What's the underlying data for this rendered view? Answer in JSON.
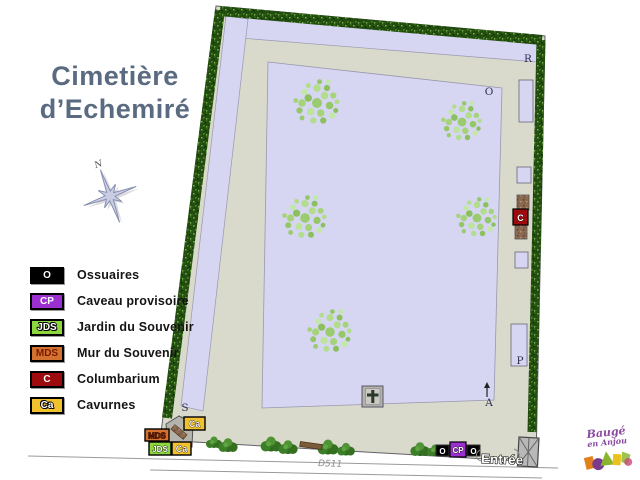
{
  "title": {
    "line1": "Cimetière",
    "line2": "d’Echemiré"
  },
  "compass": {
    "north": "N"
  },
  "legend": {
    "items": [
      {
        "code": "O",
        "label": "Ossuaires",
        "bg": "#000000",
        "fg": "#ffffff"
      },
      {
        "code": "CP",
        "label": "Caveau provisoire",
        "bg": "#9b2fd0",
        "fg": "#ffffff"
      },
      {
        "code": "JDS",
        "label": "Jardin du Souvenir",
        "bg": "#8cd73e",
        "fg": "#ffffff"
      },
      {
        "code": "MDS",
        "label": "Mur du Souvenir",
        "bg": "#d2722e",
        "fg": "#7b1a00"
      },
      {
        "code": "C",
        "label": "Columbarium",
        "bg": "#9e0b0f",
        "fg": "#ffffff"
      },
      {
        "code": "Ca",
        "label": "Cavurnes",
        "bg": "#f2c12e",
        "fg": "#ffffff"
      }
    ]
  },
  "map": {
    "sections": {
      "r": "R",
      "o": "O",
      "s": "S",
      "p": "P",
      "a": "A"
    },
    "markers": {
      "columbarium": "C",
      "cavurnes_top": "Ca",
      "mur_du_souvenir": "MDS",
      "jardin_du_souvenir": "JDS",
      "cavurnes_bottom": "Ca",
      "ossuaire_left": "O",
      "caveau_provisoire": "CP",
      "ossuaire_right": "O"
    },
    "entrance_label": "Entrée",
    "road_label": "D511"
  },
  "logo": {
    "line1": "Baugé",
    "line2": "en Anjou"
  },
  "colors": {
    "lavender": "#d6d6f2",
    "path": "#d9d9cc",
    "hedge": "#224c10",
    "title": "#5a6a80"
  }
}
